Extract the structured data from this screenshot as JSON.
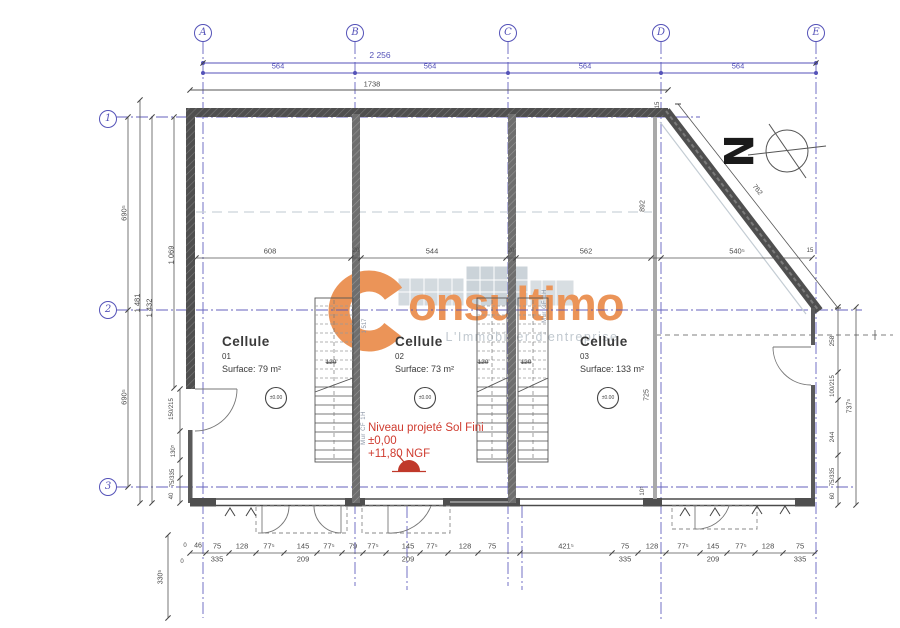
{
  "grid": {
    "cols": [
      "A",
      "B",
      "C",
      "D",
      "E"
    ],
    "rows": [
      "1",
      "2",
      "3"
    ]
  },
  "dims": {
    "top_total": "2 256",
    "top_segs": [
      "564",
      "564",
      "564",
      "564"
    ],
    "top_inner": "1738",
    "mid": [
      "608",
      "20",
      "544",
      "20",
      "562",
      "540⁵",
      "15"
    ],
    "left": {
      "seg1": "690⁵",
      "seg2": "690⁵",
      "t1": "1 481",
      "t2": "1 432",
      "t3": "1 069",
      "v": "330⁵",
      "door": "150/215",
      "d2": "130⁵",
      "d3": "75/335",
      "d4": "40"
    },
    "right": {
      "s1": "258",
      "s2": "100/215",
      "s3": "244",
      "s4": "75/335",
      "s5": "60",
      "total": "737⁵",
      "diag": "762",
      "diagv": "892",
      "inner": "725",
      "c15": "15",
      "c105": "10⁵"
    },
    "stair": {
      "door": "120",
      "dim": "1 517"
    },
    "bottom_left": [
      "0",
      "46",
      "75",
      "128",
      "77⁵",
      "145",
      "77⁵",
      "79",
      "77⁵",
      "145",
      "77⁵",
      "128",
      "75"
    ],
    "bottom_left_sub": [
      "335",
      "209",
      "209"
    ],
    "bottom_right": [
      "421⁵",
      "75",
      "128",
      "77⁵",
      "145",
      "77⁵",
      "128",
      "75"
    ],
    "bottom_right_sub": [
      "335",
      "209",
      "335"
    ],
    "zero": "0"
  },
  "cells": [
    {
      "title": "Cellule",
      "num": "01",
      "surface": "Surface: 79 m²"
    },
    {
      "title": "Cellule",
      "num": "02",
      "surface": "Surface: 73 m²"
    },
    {
      "title": "Cellule",
      "num": "03",
      "surface": "Surface: 133 m²"
    }
  ],
  "levels": {
    "marker": "±0.00"
  },
  "note": {
    "l1": "Niveau projeté Sol Fini",
    "l2": "±0,00",
    "l3": "+11,80 NGF"
  },
  "labels": {
    "wall": "Mur CF 1H",
    "north": "N"
  },
  "watermark": {
    "name": "onsultimo",
    "tagline": "L'Immobilier d'entreprise",
    "accent": "#E8823B"
  }
}
